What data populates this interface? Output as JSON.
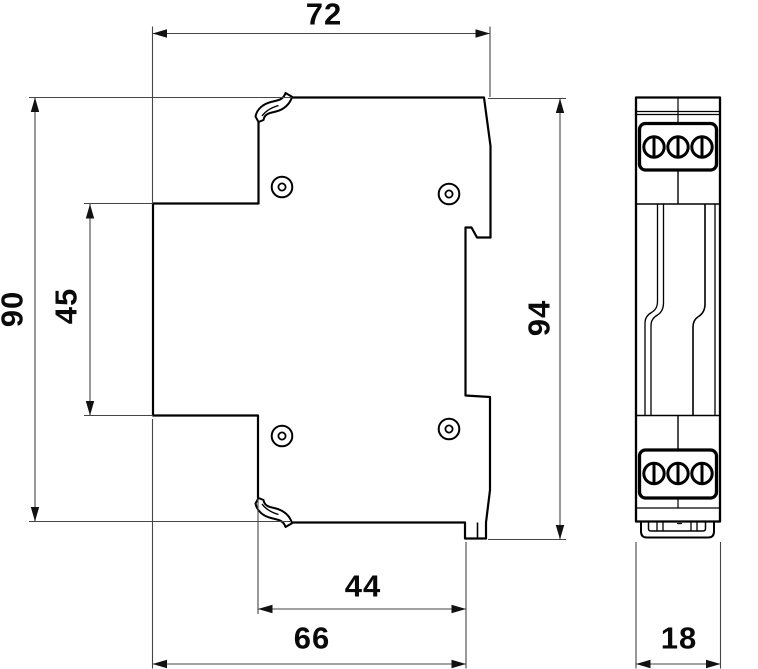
{
  "drawing": {
    "type": "dimensional technical drawing",
    "subject": "DIN-rail mounted device shown in side view and front view",
    "views": [
      {
        "id": "side-view",
        "description": "side profile with DIN-rail channel, terminal cover latches and four screw recesses"
      },
      {
        "id": "front-view",
        "description": "narrow front face with two 3-screw terminal blocks and bottom rail clip"
      }
    ],
    "dimensions": [
      {
        "id": "d72",
        "label": "72",
        "role": "overall depth, top of side view"
      },
      {
        "id": "d90",
        "label": "90",
        "role": "body height, left of side view"
      },
      {
        "id": "d45",
        "label": "45",
        "role": "front-face height, left of side view"
      },
      {
        "id": "d94",
        "label": "94",
        "role": "overall height incl. clip, right of side view"
      },
      {
        "id": "d44",
        "label": "44",
        "role": "recess depth, bottom of side view"
      },
      {
        "id": "d66",
        "label": "66",
        "role": "base depth, bottom of side view"
      },
      {
        "id": "d18",
        "label": "18",
        "role": "module width, bottom of front view"
      }
    ],
    "colors": {
      "outline": "#000000",
      "dimension_line": "#454545",
      "text": "#0a0a0a",
      "background": "#ffffff"
    }
  }
}
